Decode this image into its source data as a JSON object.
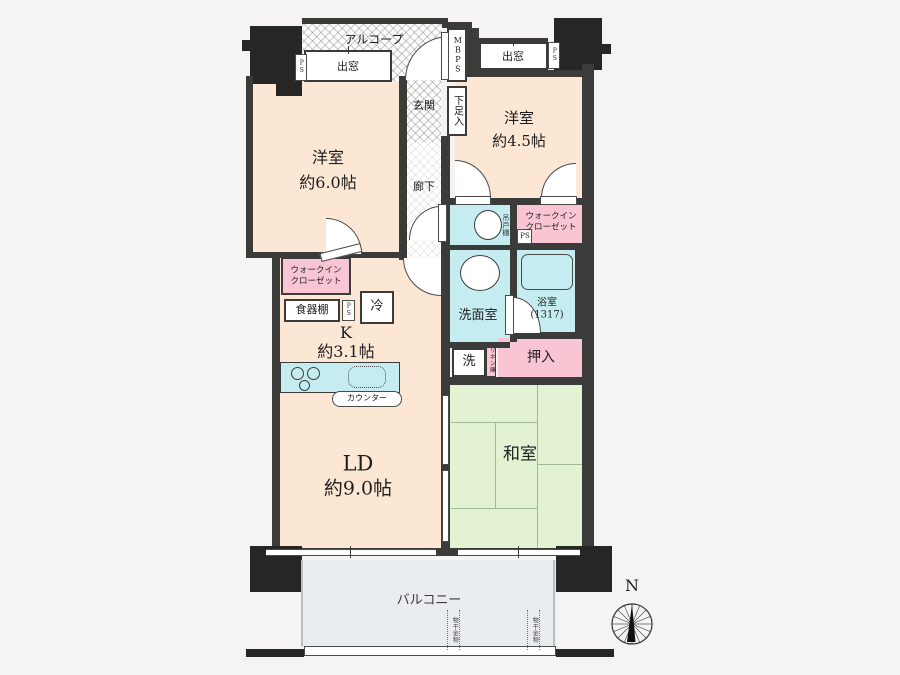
{
  "labels": {
    "alcove": "アルコープ",
    "mbps": "MBPS",
    "bay_window_left": "出窓",
    "bay_window_right": "出窓",
    "ps_left": "PS",
    "ps_right": "PS",
    "ps_kitchen": "PS",
    "ps_wic": "PS",
    "entrance": "玄関",
    "shoe_cabinet": "下足入",
    "corridor": "廊下",
    "western_room_6": "洋室",
    "western_room_6_size": "約6.0帖",
    "western_room_45": "洋室",
    "western_room_45_size": "約4.5帖",
    "wic_line1": "ウォークイン",
    "wic_line2": "クローゼット",
    "hanging_cupboard": "吊戸棚",
    "cupboard": "食器棚",
    "fridge": "冷",
    "kitchen": "K",
    "kitchen_size": "約3.1帖",
    "counter": "カウンター",
    "washroom": "洗面室",
    "bathroom": "浴室",
    "bathroom_size": "(1317)",
    "washer": "洗",
    "linen": "リネン庫",
    "oshiire": "押入",
    "ld": "LD",
    "ld_size": "約9.0帖",
    "japanese_room": "和室",
    "balcony": "バルコニー",
    "laundry_hook": "物干金物",
    "north": "N"
  },
  "colors": {
    "wall": "#3b3b39",
    "room_peach": "#fbe7d3",
    "room_green": "#e2f2d2",
    "room_cyan": "#c5edf1",
    "room_pink": "#f9c5d3",
    "balcony": "#e9edf0"
  }
}
